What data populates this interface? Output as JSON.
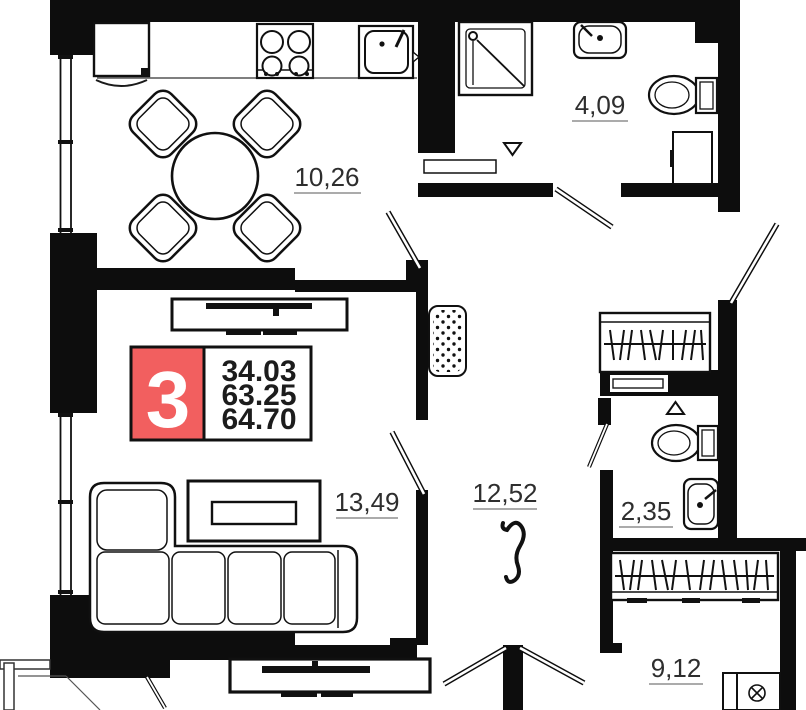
{
  "plan": {
    "badge": {
      "rooms_count": "3",
      "values": [
        "34.03",
        "63.25",
        "64.70"
      ]
    },
    "rooms": [
      {
        "id": "kitchen",
        "area": "10,26"
      },
      {
        "id": "bathroom",
        "area": "4,09"
      },
      {
        "id": "living",
        "area": "13,49"
      },
      {
        "id": "hall",
        "area": "12,52"
      },
      {
        "id": "wc",
        "area": "2,35"
      },
      {
        "id": "bedroom",
        "area": "9,12"
      }
    ],
    "colors": {
      "badge_red": "#f25f5f",
      "wall": "#0d0d0d",
      "label": "#2e2e2e",
      "background": "#ffffff"
    }
  }
}
